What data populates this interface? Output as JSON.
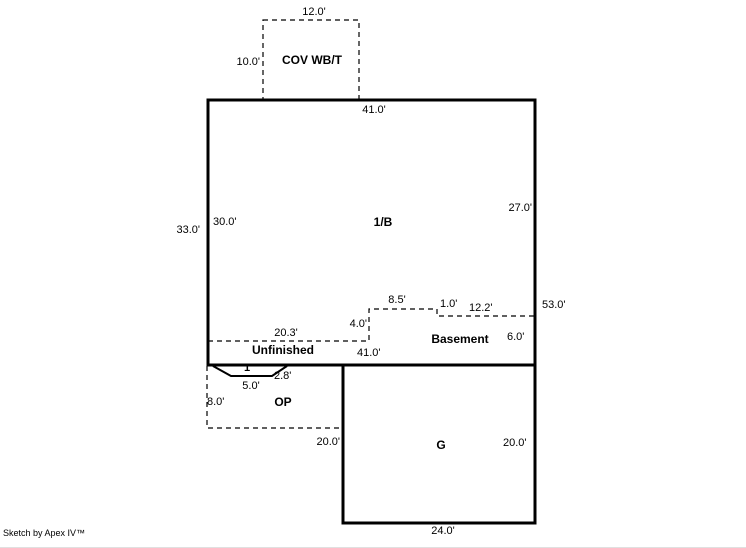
{
  "sketch": {
    "credit": "Sketch by Apex IV™",
    "colors": {
      "line": "#000000",
      "background": "#ffffff",
      "text": "#000000"
    },
    "areas": {
      "cov_porch": {
        "label": "COV WB/T",
        "dims": {
          "top": "12.0'",
          "left": "10.0'"
        }
      },
      "first_floor": {
        "label": "1/B",
        "dims": {
          "top": "41.0'",
          "left_outer": "33.0'",
          "left_inner": "30.0'",
          "right_inner": "27.0'",
          "right_outer": "53.0'"
        }
      },
      "basement": {
        "label": "Basement",
        "unfinished_label": "Unfinished",
        "dims": {
          "seg_20_3": "20.3'",
          "seg_4_0": "4.0'",
          "seg_8_5": "8.5'",
          "seg_1_0": "1.0'",
          "seg_12_2": "12.2'",
          "right": "6.0'",
          "bottom": "41.0'"
        }
      },
      "bay": {
        "label": "1",
        "dims": {
          "side": "2.8'",
          "bottom": "5.0'"
        }
      },
      "open_porch": {
        "label": "OP",
        "dims": {
          "left": "8.0'"
        }
      },
      "garage": {
        "label": "G",
        "dims": {
          "left": "20.0'",
          "right": "20.0'",
          "bottom": "24.0'"
        }
      }
    }
  }
}
